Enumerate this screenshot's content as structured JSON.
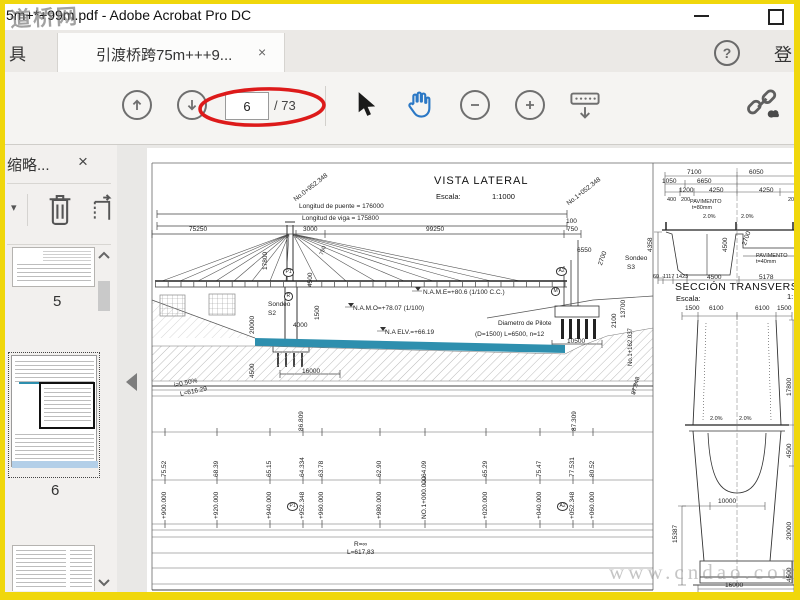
{
  "colors": {
    "highlight_red": "#dd1a1a",
    "water_blue": "#2e8fae",
    "selection_blue": "#b3cfe8",
    "hand_blue": "#2b78c5",
    "border_yellow": "#f0d70c"
  },
  "window": {
    "title": "5m+*+99m.pdf - Adobe Acrobat Pro DC"
  },
  "watermarks": {
    "top_left": "道桥网",
    "bottom_right": "www.cndao.com"
  },
  "tab_bar": {
    "tools_label": "具",
    "active_tab_label": "引渡桥跨75m+++9...",
    "close_glyph": "×",
    "help_glyph": "?",
    "sign_in_label": "登"
  },
  "toolbar": {
    "page_current": "6",
    "page_total": "/ 73"
  },
  "sidebar": {
    "panel_title": "缩略...",
    "close_glyph": "×",
    "page_labels": [
      "5",
      "6",
      "7"
    ]
  },
  "drawing": {
    "vista": {
      "title": "VISTA LATERAL",
      "escala_label": "Escala:",
      "escala_value": "1:1000",
      "sta_left": "No.0+952.348",
      "sta_right": "No.1+052.348",
      "sta_far": "No.1+162.037",
      "len_puente": "Longitud de puente = 176000",
      "len_viga": "Longitud de viga = 175800",
      "d75250": "75250",
      "d3000": "3000",
      "d99250": "99250",
      "d100": "100",
      "d750": "750",
      "d17800": "17800",
      "d4500_tower": "4500",
      "d750_seg": "750",
      "p1": "P1",
      "r": "R",
      "a2": "A2",
      "m": "M",
      "d6550": "6550",
      "d2700": "2700",
      "sondeo": "Sondeo",
      "s2": "S2",
      "s3": "S3",
      "d20000": "20000",
      "d4000": "4000",
      "d1500": "1500",
      "d4500_left": "4500",
      "name_lvl": "N.A.M.E=+80.6 (1/100 C.C.)",
      "namo_lvl": "N.A.M.O=+78.07 (1/100)",
      "na_elv": "N.A ELV.=+66.19",
      "pilote_1": "Diametro de Pilote",
      "pilote_2": "(D=1500) L=6500, n=12",
      "d10500": "10500",
      "d16000": "16000",
      "d13700": "13700",
      "d2100": "2100",
      "v87848": "87.848"
    },
    "profile_table": {
      "grade_i": "i=0.50%",
      "grade_l": "L=616.29",
      "radius": "R=∞",
      "radius_l": "L=617,83",
      "peak_left": "86.809",
      "peak_right": "87.309",
      "elevations": [
        "75.52",
        "68.39",
        "65.15",
        "64.334",
        "63.78",
        "62.90",
        "64.09",
        "65.29",
        "75.47",
        "77.531",
        "80.52"
      ],
      "stations": [
        "+900.000",
        "+920.000",
        "+940.000",
        "+952.348",
        "+960.000",
        "+980.000",
        "NO.1+000.000",
        "+020.000",
        "+040.000",
        "+052.348",
        "+060.000"
      ]
    },
    "section": {
      "title": "SECCIÓN TRANSVERS",
      "escala_label": "Escala:",
      "scale_partial": "1:",
      "pav80_1": "PAVIMENTO",
      "pav80_2": "t=80mm",
      "pav40_1": "PAVIMENTO",
      "pav40_2": "t=40mm",
      "slope": "2.0%",
      "d7100": "7100",
      "d6050": "6050",
      "d1050": "1050",
      "d6650": "6650",
      "d1200": "1200",
      "d4250a": "4250",
      "d4250b": "4250",
      "d400": "400",
      "d200a": "200",
      "d200b": "200",
      "d2700": "2700",
      "d4500_web": "4500",
      "d4358": "4358",
      "d60": "60",
      "d1117": "1117",
      "d1423": "1423",
      "d4500_bot": "4500",
      "d5178": "5178",
      "d1500a": "1500",
      "d6100a": "6100",
      "d6100b": "6100",
      "d1500b": "1500",
      "d17800": "17800",
      "d4500_r1": "4500",
      "d10000": "10000",
      "d15387": "15387",
      "d16000": "16000",
      "d20000": "20000",
      "d4500_r2": "4500"
    }
  }
}
